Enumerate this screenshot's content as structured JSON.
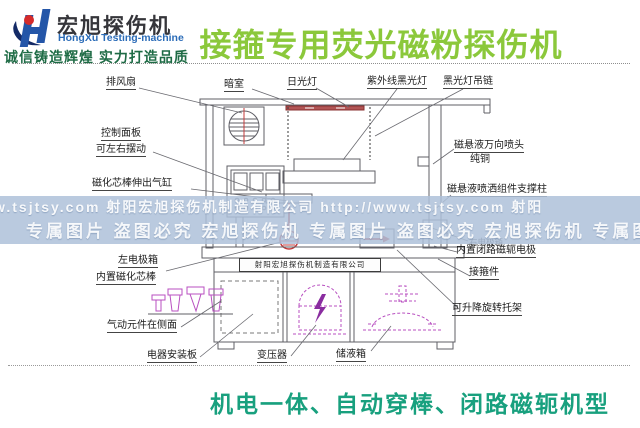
{
  "header": {
    "brand_cn": "宏旭探伤机",
    "brand_en": "HongXu Testing-machine",
    "slogan": "诚信铸造辉煌 实力打造品质",
    "title": "接箍专用荧光磁粉探伤机"
  },
  "watermark": {
    "line1": "w.tsjtsy.com 射阳宏旭探伤机制造有限公司  http://www.tsjtsy.com 射阳",
    "line2": "专属图片 盗图必究  宏旭探伤机 专属图片 盗图必究  宏旭探伤机 专属图"
  },
  "diagram": {
    "nameplate": "射阳宏旭探伤机制造有限公司",
    "labels": {
      "exhaust_fan": "排风扇",
      "dark_room": "暗室",
      "daylight_lamp": "日光灯",
      "uv_black_light": "紫外线黑光灯",
      "black_light_chain": "黑光灯吊链",
      "control_panel_1": "控制面板",
      "control_panel_2": "可左右摆动",
      "core_rod_cylinder": "磁化芯棒伸出气缸",
      "left_electrode_1": "左电极箱",
      "left_electrode_2": "内置磁化芯棒",
      "pneumatic": "气动元件在侧面",
      "electric_plate": "电器安装板",
      "transformer": "变压器",
      "tank": "储液箱",
      "nozzle_1": "磁悬液万向喷头",
      "nozzle_2": "纯铜",
      "support_column": "磁悬液喷洒组件支撑柱",
      "right_electrode_1": "右电极箱",
      "right_electrode_2": "内置闭路磁轭电极",
      "coupling": "接箍件",
      "bracket": "可升降旋转托架"
    }
  },
  "footer": {
    "caption": "机电一体、自动穿棒、闭路磁轭机型"
  },
  "colors": {
    "title_green": "#8bc83b",
    "caption_teal": "#18a07e",
    "slogan_green": "#1e6b45",
    "brand_blue": "#2b6cb8",
    "watermark_band": "#aec1d9",
    "diagram_line": "#5f5f66",
    "accent_red": "#c43b3b",
    "accent_magenta": "#b84fc0"
  }
}
